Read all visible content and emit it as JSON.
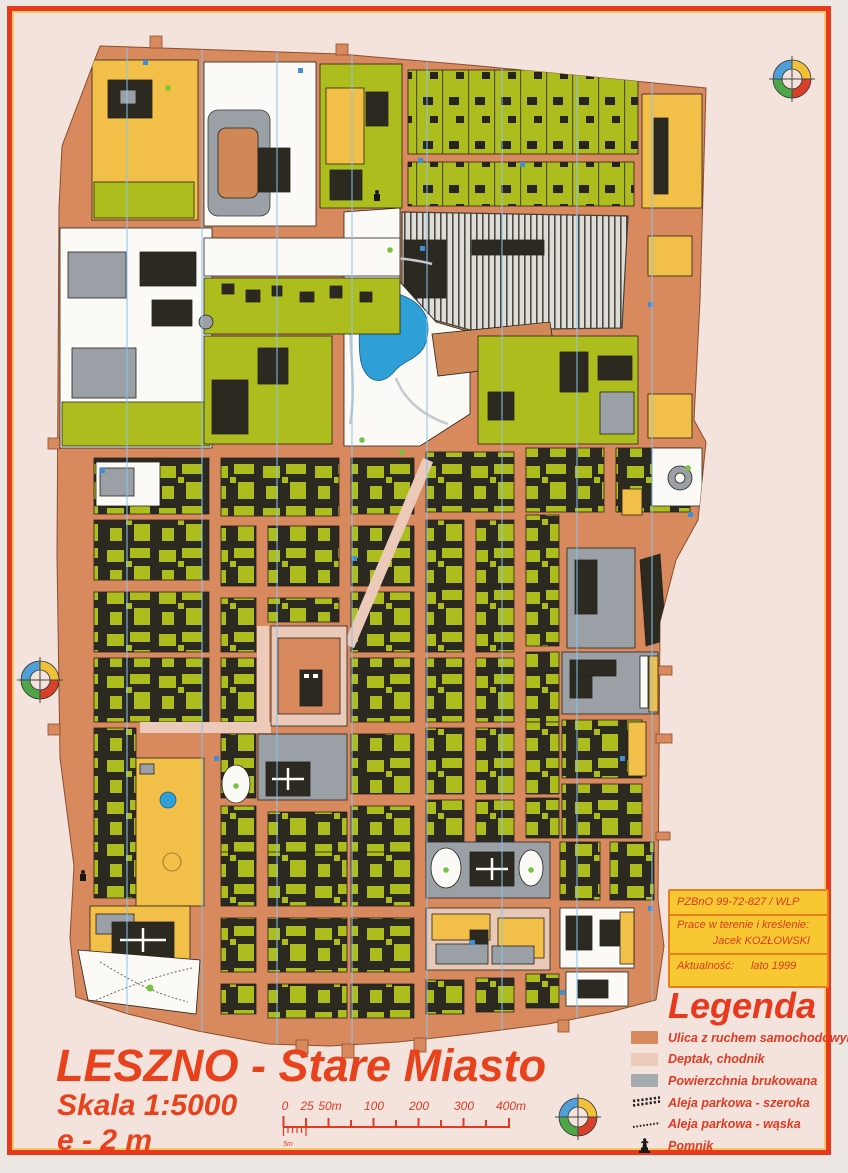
{
  "title_block": {
    "title": "LESZNO - Stare Miasto",
    "scale": "Skala 1:5000",
    "contour_interval": "e - 2 m"
  },
  "scale_bar": {
    "labels": [
      "0",
      "25",
      "50m",
      "100",
      "200",
      "300",
      "400m"
    ],
    "sub_label": "5m"
  },
  "credits_box": {
    "registration": "PZBnO  99-72-827 / WLP",
    "fieldwork_label": "Prace w terenie i kreślenie:",
    "fieldwork_author": "Jacek KOZŁOWSKI",
    "currency_label": "Aktualność:",
    "currency_value": "lato 1999"
  },
  "legend": {
    "title": "Legenda",
    "items": [
      {
        "label": "Ulica z ruchem samochodowym",
        "symbol": "street-swatch",
        "color": "#d9895e"
      },
      {
        "label": "Deptak, chodnik",
        "symbol": "sidewalk-swatch",
        "color": "#eccab9"
      },
      {
        "label": "Powierzchnia brukowana",
        "symbol": "paved-swatch",
        "color": "#a6abb0"
      },
      {
        "label": "Aleja parkowa - szeroka",
        "symbol": "alley-wide"
      },
      {
        "label": "Aleja parkowa - wąska",
        "symbol": "alley-narrow"
      },
      {
        "label": "Pomnik",
        "symbol": "monument"
      }
    ]
  },
  "map_colors": {
    "street": "#d9895e",
    "sidewalk": "#eccab9",
    "paved_gray": "#9aa0a6",
    "building_black": "#2b2920",
    "vegetation": "#aebd1e",
    "open_yellow": "#f2bf48",
    "open_white": "#fbfaf7",
    "water": "#2f9fd8",
    "north_line": "#8cc4ea",
    "frame": "#e8391d",
    "accent_text": "#e33d20",
    "credits_bg": "#f8c832"
  }
}
